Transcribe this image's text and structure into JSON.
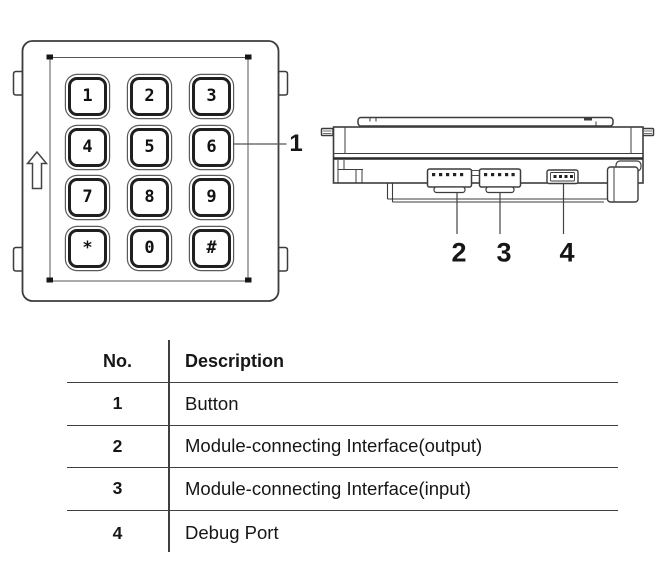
{
  "colors": {
    "line": "#3c3c3c",
    "line_dark": "#1f1f1f",
    "text": "#161616"
  },
  "callouts": {
    "c1": "1",
    "c2": "2",
    "c3": "3",
    "c4": "4"
  },
  "keypad": {
    "keys": [
      {
        "label": "1",
        "name": "1"
      },
      {
        "label": "2",
        "name": "2"
      },
      {
        "label": "3",
        "name": "3"
      },
      {
        "label": "4",
        "name": "4"
      },
      {
        "label": "5",
        "name": "5"
      },
      {
        "label": "6",
        "name": "6"
      },
      {
        "label": "7",
        "name": "7"
      },
      {
        "label": "8",
        "name": "8"
      },
      {
        "label": "9",
        "name": "9"
      },
      {
        "label": "*",
        "name": "star"
      },
      {
        "label": "0",
        "name": "0"
      },
      {
        "label": "#",
        "name": "pound"
      }
    ]
  },
  "table": {
    "headers": {
      "no": "No.",
      "description": "Description"
    },
    "rows": [
      {
        "no": "1",
        "description": "Button"
      },
      {
        "no": "2",
        "description": "Module-connecting Interface(output)"
      },
      {
        "no": "3",
        "description": "Module-connecting Interface(input)"
      },
      {
        "no": "4",
        "description": "Debug Port"
      }
    ]
  }
}
